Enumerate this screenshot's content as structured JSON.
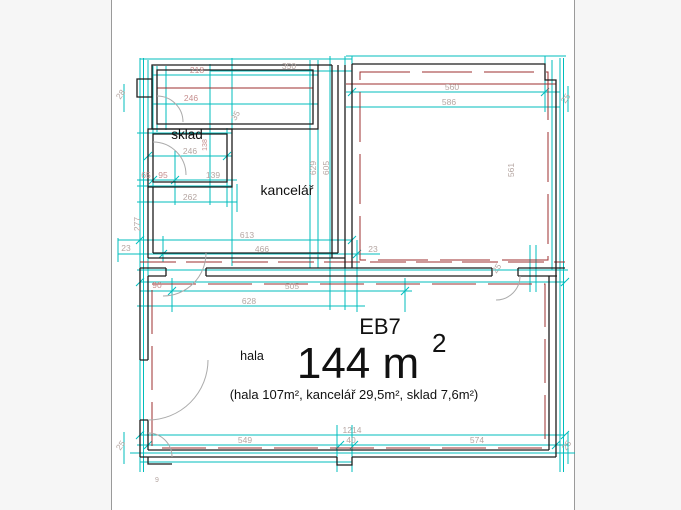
{
  "unit": {
    "code": "EB7",
    "area_main": "144 m",
    "area_sup": "2",
    "area_details": "(hala 107m², kancelář 29,5m², sklad 7,6m²)"
  },
  "rooms": [
    {
      "label": "sklad"
    },
    {
      "label": "kancelář"
    },
    {
      "label": "hala"
    }
  ],
  "dimensions": [
    {
      "value": "218",
      "x": 197,
      "y": 73
    },
    {
      "value": "246",
      "x": 191,
      "y": 101
    },
    {
      "value": "28",
      "x": 123,
      "y": 96,
      "rot": -55,
      "alt": true
    },
    {
      "value": "350",
      "x": 289,
      "y": 69,
      "alt": true
    },
    {
      "value": "560",
      "x": 452,
      "y": 90,
      "alt": true
    },
    {
      "value": "586",
      "x": 449,
      "y": 105,
      "alt": true
    },
    {
      "value": "25",
      "x": 568,
      "y": 100,
      "rot": -55,
      "alt": true
    },
    {
      "value": "246",
      "x": 190,
      "y": 154,
      "alt": true
    },
    {
      "value": "65",
      "x": 146,
      "y": 178
    },
    {
      "value": "95",
      "x": 163,
      "y": 178
    },
    {
      "value": "139",
      "x": 213,
      "y": 178,
      "alt": true
    },
    {
      "value": "262",
      "x": 190,
      "y": 200,
      "alt": true
    },
    {
      "value": "277",
      "x": 140,
      "y": 224,
      "rot": -90,
      "alt": true
    },
    {
      "value": "35",
      "x": 238,
      "y": 117,
      "rot": -60,
      "alt": true
    },
    {
      "value": "138",
      "x": 207,
      "y": 145,
      "rot": -90,
      "s": 7
    },
    {
      "value": "629",
      "x": 316,
      "y": 168,
      "rot": -90,
      "alt": true
    },
    {
      "value": "605",
      "x": 329,
      "y": 168,
      "rot": -90,
      "alt": true
    },
    {
      "value": "613",
      "x": 247,
      "y": 238,
      "alt": true
    },
    {
      "value": "466",
      "x": 262,
      "y": 252,
      "alt": true
    },
    {
      "value": "23",
      "x": 126,
      "y": 251,
      "alt": true
    },
    {
      "value": "23",
      "x": 373,
      "y": 252,
      "alt": true
    },
    {
      "value": "90",
      "x": 157,
      "y": 288
    },
    {
      "value": "505",
      "x": 292,
      "y": 289,
      "alt": true
    },
    {
      "value": "628",
      "x": 249,
      "y": 304,
      "alt": true
    },
    {
      "value": "561",
      "x": 514,
      "y": 170,
      "rot": -90,
      "alt": true
    },
    {
      "value": "25",
      "x": 499,
      "y": 270,
      "rot": -55,
      "alt": true
    },
    {
      "value": "1214",
      "x": 352,
      "y": 433,
      "alt": true
    },
    {
      "value": "549",
      "x": 245,
      "y": 443,
      "alt": true
    },
    {
      "value": "40",
      "x": 351,
      "y": 443,
      "alt": true
    },
    {
      "value": "574",
      "x": 477,
      "y": 443,
      "alt": true
    },
    {
      "value": "25",
      "x": 123,
      "y": 447,
      "rot": -55,
      "alt": true
    },
    {
      "value": "25",
      "x": 569,
      "y": 447,
      "rot": -55,
      "alt": true
    },
    {
      "value": "9",
      "x": 157,
      "y": 482,
      "s": 7,
      "alt": true
    }
  ],
  "colors": {
    "dimension_line": "#00bdbd",
    "wall": "#1c1c1c",
    "inner_line": "#9c2f2f",
    "dim_text": "#c68f8f",
    "dim_text_alt": "#b5a6a2",
    "door_arc": "#ababab",
    "canvas": "#ffffff",
    "margin": "#f6f6f6"
  }
}
